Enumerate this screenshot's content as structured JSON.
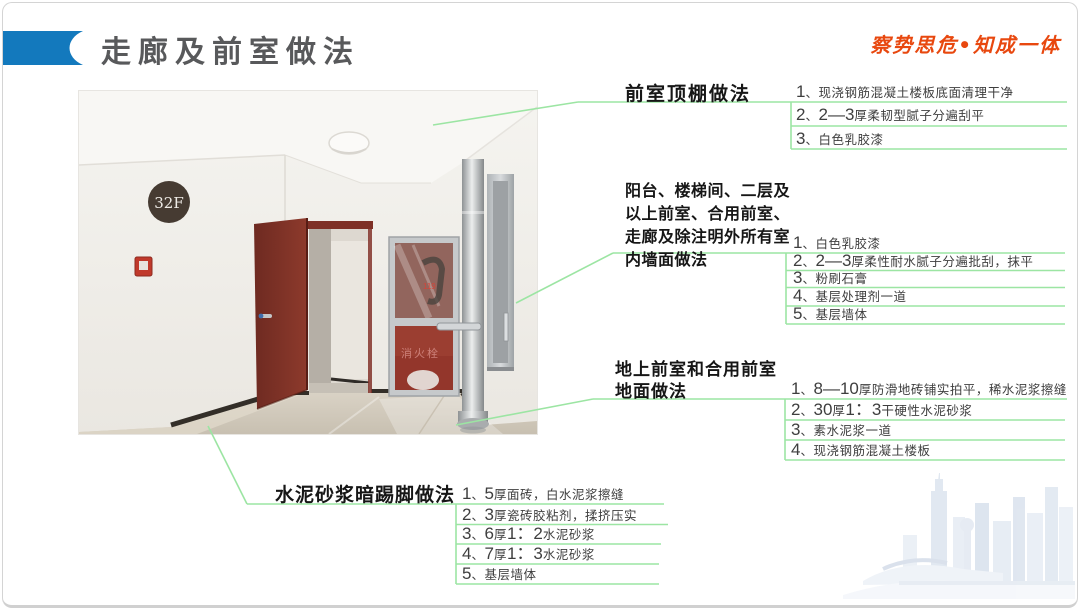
{
  "slide": {
    "title": "走廊及前室做法",
    "motto": "察势思危•知成一体"
  },
  "annotations": {
    "ceiling": {
      "heading": "前室顶棚做法",
      "items": [
        "1、现浇钢筋混凝土楼板底面清理干净",
        "2、2—3厚柔韧型腻子分遍刮平",
        "3、白色乳胶漆"
      ]
    },
    "walls": {
      "heading": "阳台、楼梯间、二层及\n以上前室、合用前室、\n走廊及除注明外所有室\n内墙面做法",
      "items": [
        "1、白色乳胶漆",
        "2、2—3厚柔性耐水腻子分遍批刮，抹平",
        "3、粉刷石膏",
        "4、基层处理剂一道",
        "5、基层墙体"
      ]
    },
    "floor": {
      "heading": "地上前室和合用前室\n地面做法",
      "items": [
        "1、8—10厚防滑地砖铺实拍平，稀水泥浆擦缝",
        "2、30厚1：3干硬性水泥砂浆",
        "3、素水泥浆一道",
        "4、现浇钢筋混凝土楼板"
      ]
    },
    "skirting": {
      "heading": "水泥砂浆暗踢脚做法",
      "items": [
        "1、5厚面砖，白水泥浆擦缝",
        "2、3厚瓷砖胶粘剂，揉挤压实",
        "3、6厚1：2水泥砂浆",
        "4、7厚1：3水泥砂浆",
        "5、基层墙体"
      ]
    }
  },
  "photo": {
    "floor_sign": "32F",
    "cabinet_label": "消火栓",
    "cabinet_number": "119"
  },
  "colors": {
    "accent_blue": "#1379bd",
    "title_gray": "#58595b",
    "motto_red": "#e8480f",
    "leader_green": "#9ce5a3"
  }
}
